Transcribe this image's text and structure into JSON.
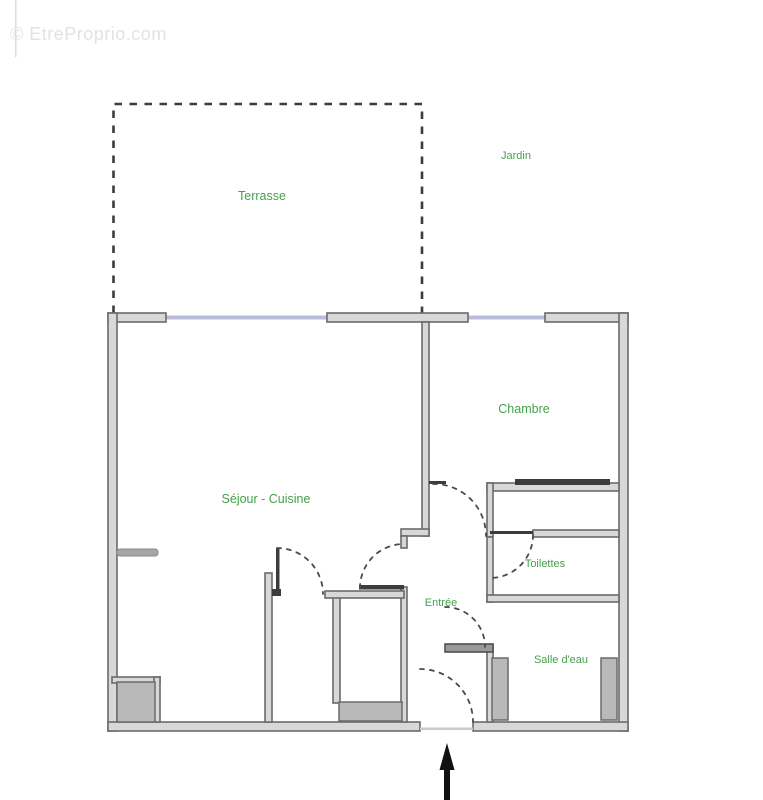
{
  "watermark": "© EtreProprio.com",
  "floor_plan": {
    "type": "apartment-floor-plan",
    "rooms": [
      {
        "id": "terrasse",
        "label": "Terrasse"
      },
      {
        "id": "jardin",
        "label": "Jardin"
      },
      {
        "id": "chambre",
        "label": "Chambre"
      },
      {
        "id": "sejour-cuisine",
        "label": "Séjour - Cuisine"
      },
      {
        "id": "toilettes",
        "label": "Toilettes"
      },
      {
        "id": "entree",
        "label": "Entrée"
      },
      {
        "id": "salle-deau",
        "label": "Salle d'eau"
      }
    ],
    "entrance_arrow_direction": "up",
    "colors": {
      "background": "#ffffff",
      "wall_fill": "#d8d8d8",
      "wall_stroke": "#6a6a6a",
      "window_line": "#b9bcd8",
      "room_label_green": "#45a14c",
      "door_arc": "#4a4a4a",
      "fixture_gray": "#b9b9b9",
      "arrow_black": "#111111",
      "watermark_gray": "#e2e2e2"
    }
  }
}
